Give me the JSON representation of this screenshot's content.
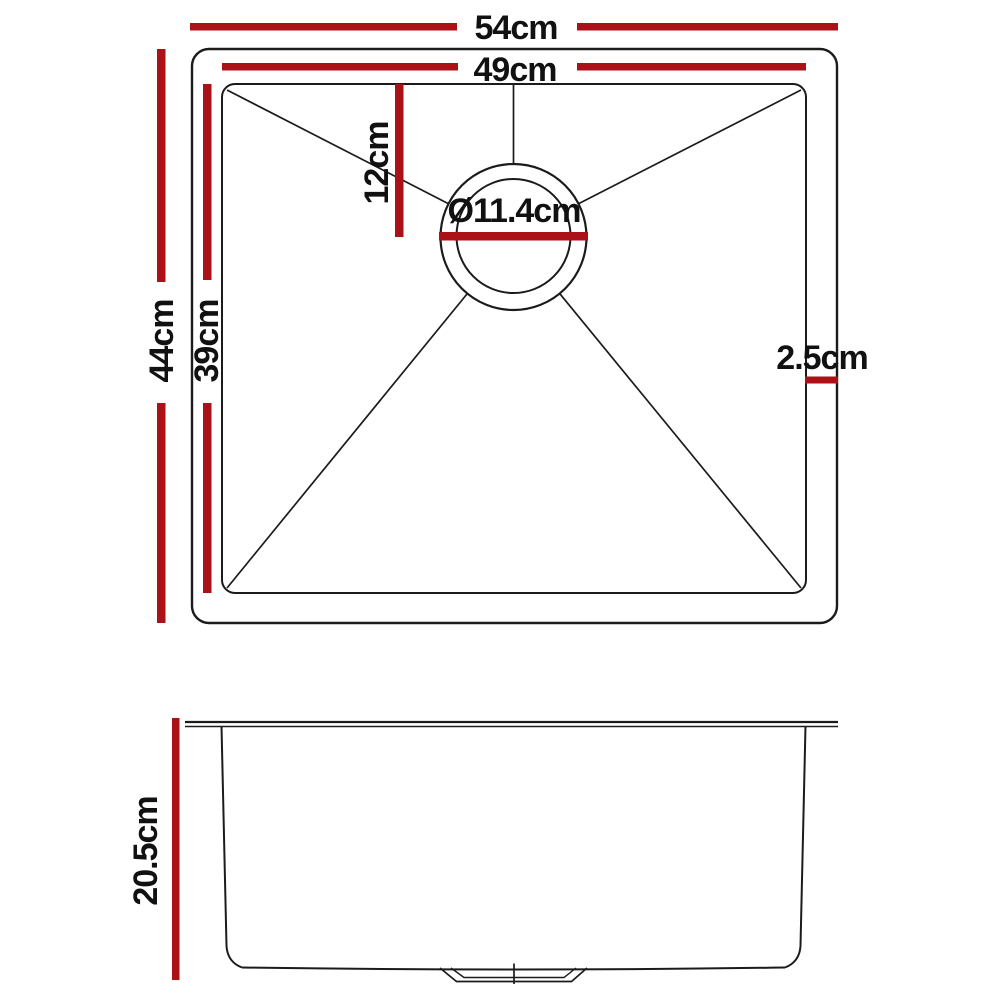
{
  "colors": {
    "dimension_red": "#ab1218",
    "line_black": "#1b1b1b",
    "background": "#ffffff"
  },
  "top_view": {
    "outer_width_label": "54cm",
    "inner_width_label": "49cm",
    "outer_depth_label": "44cm",
    "inner_depth_label": "39cm",
    "drain_offset_label": "12cm",
    "drain_diameter_label": "Ø11.4cm",
    "rim_width_label": "2.5cm"
  },
  "side_view": {
    "bowl_depth_label": "20.5cm"
  }
}
